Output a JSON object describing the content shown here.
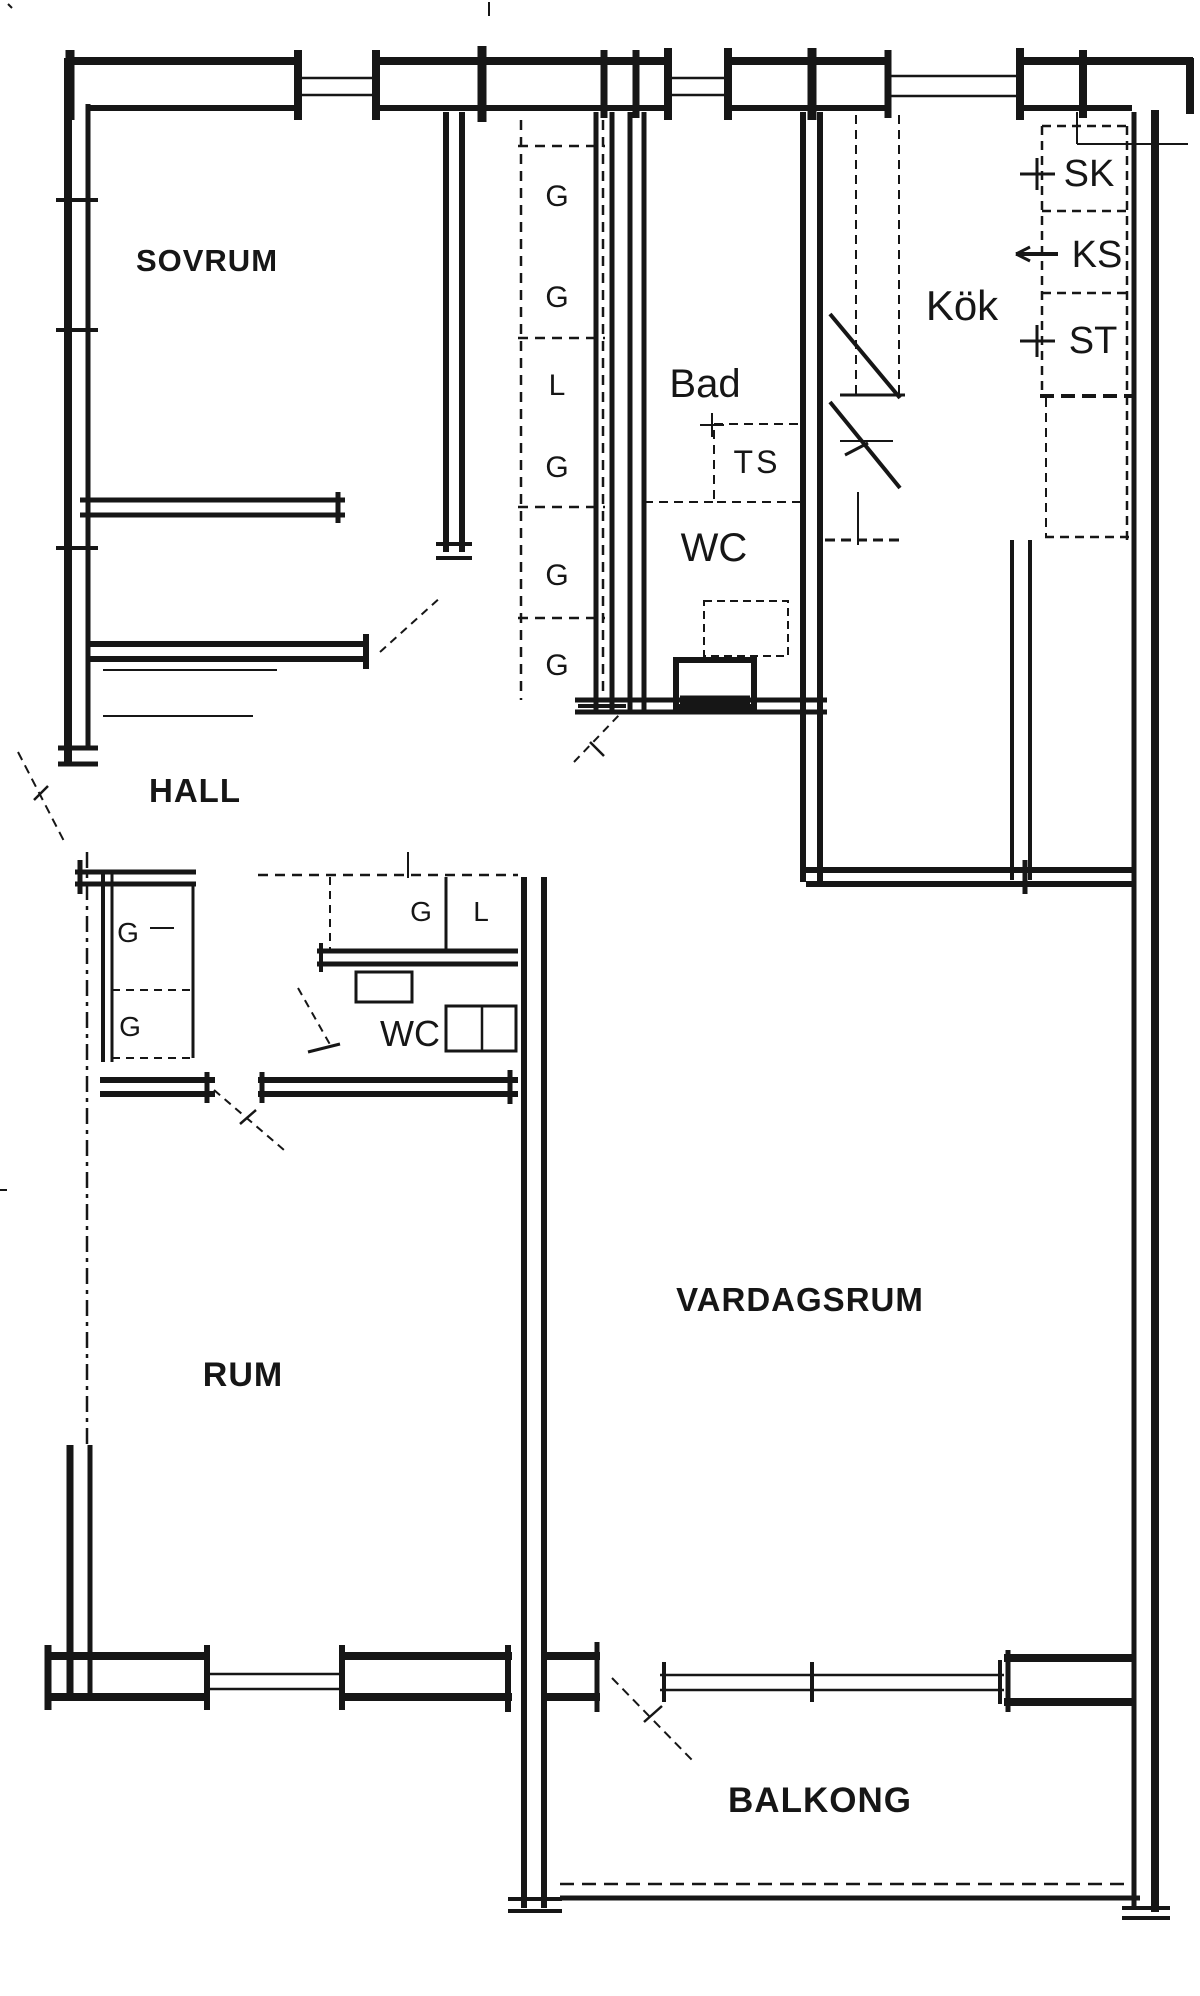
{
  "document": {
    "type": "apartment floor plan (scanned architectural drawing)",
    "language": "Swedish",
    "ink_color": "#161616",
    "paper_color": "#ffffff"
  },
  "labels": {
    "rooms": {
      "sovrum": "SOVRUM",
      "hall": "HALL",
      "bad": "Bad",
      "wc": "WC",
      "kok": "Kök",
      "rum": "RUM",
      "vardagsrum": "VARDAGSRUM",
      "balkong": "BALKONG"
    },
    "storage": {
      "g": "G",
      "l": "L",
      "ts": "TS",
      "sk": "SK",
      "ks": "KS",
      "st": "ST"
    }
  }
}
